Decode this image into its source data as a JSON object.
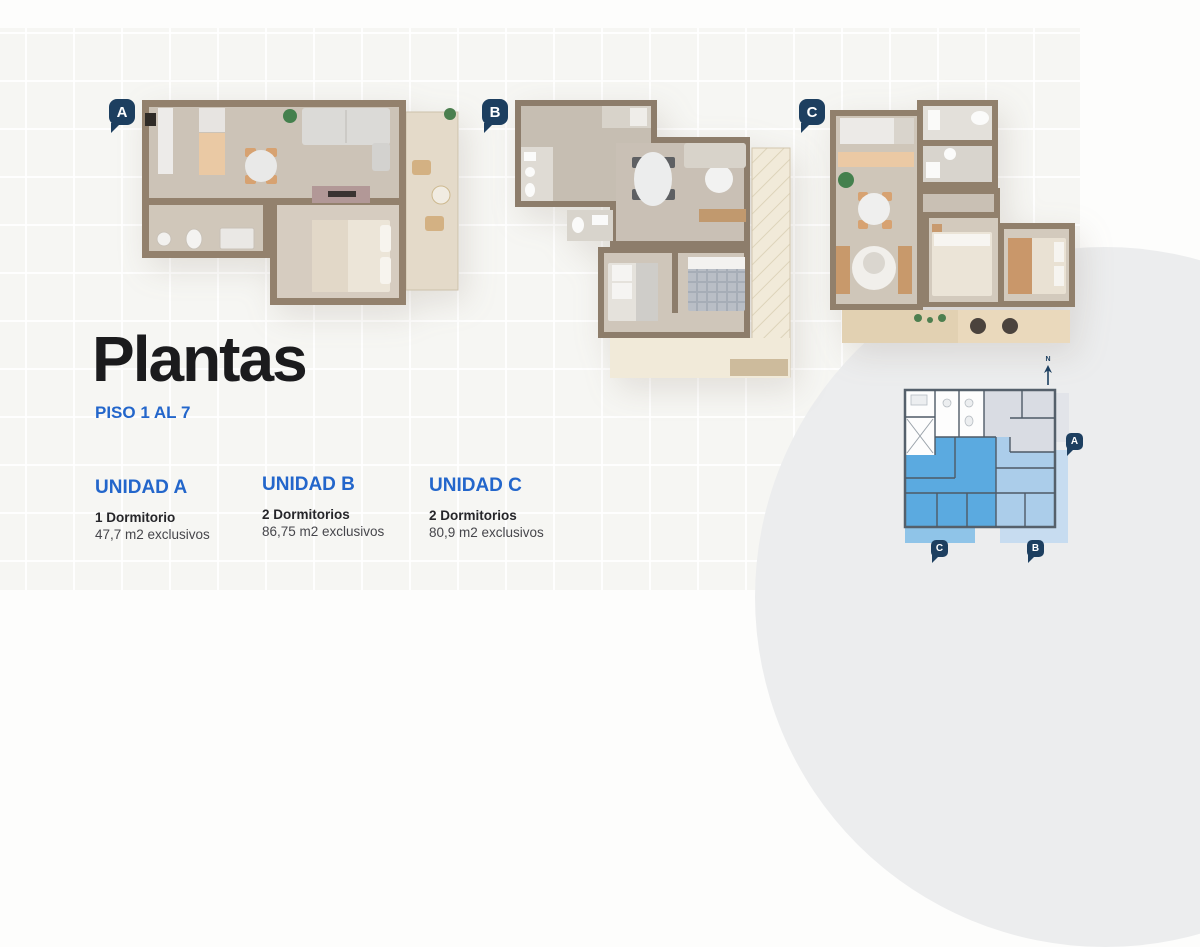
{
  "page": {
    "title": "Plantas",
    "subtitle": "PISO 1 AL 7"
  },
  "units": [
    {
      "label": "A",
      "name": "UNIDAD A",
      "bedrooms": "1 Dormitorio",
      "area": "47,7 m2 exclusivos"
    },
    {
      "label": "B",
      "name": "UNIDAD B",
      "bedrooms": "2 Dormitorios",
      "area": "86,75 m2 exclusivos"
    },
    {
      "label": "C",
      "name": "UNIDAD C",
      "bedrooms": "2 Dormitorios",
      "area": "80,9 m2 exclusivos"
    }
  ],
  "keyplan": {
    "north_label": "N"
  },
  "colors": {
    "accent_blue": "#2366cb",
    "marker_navy": "#1d3f60",
    "unit_a_fill": "#d9dce3",
    "unit_b_fill": "#abcdea",
    "unit_c_fill": "#5baae0"
  }
}
